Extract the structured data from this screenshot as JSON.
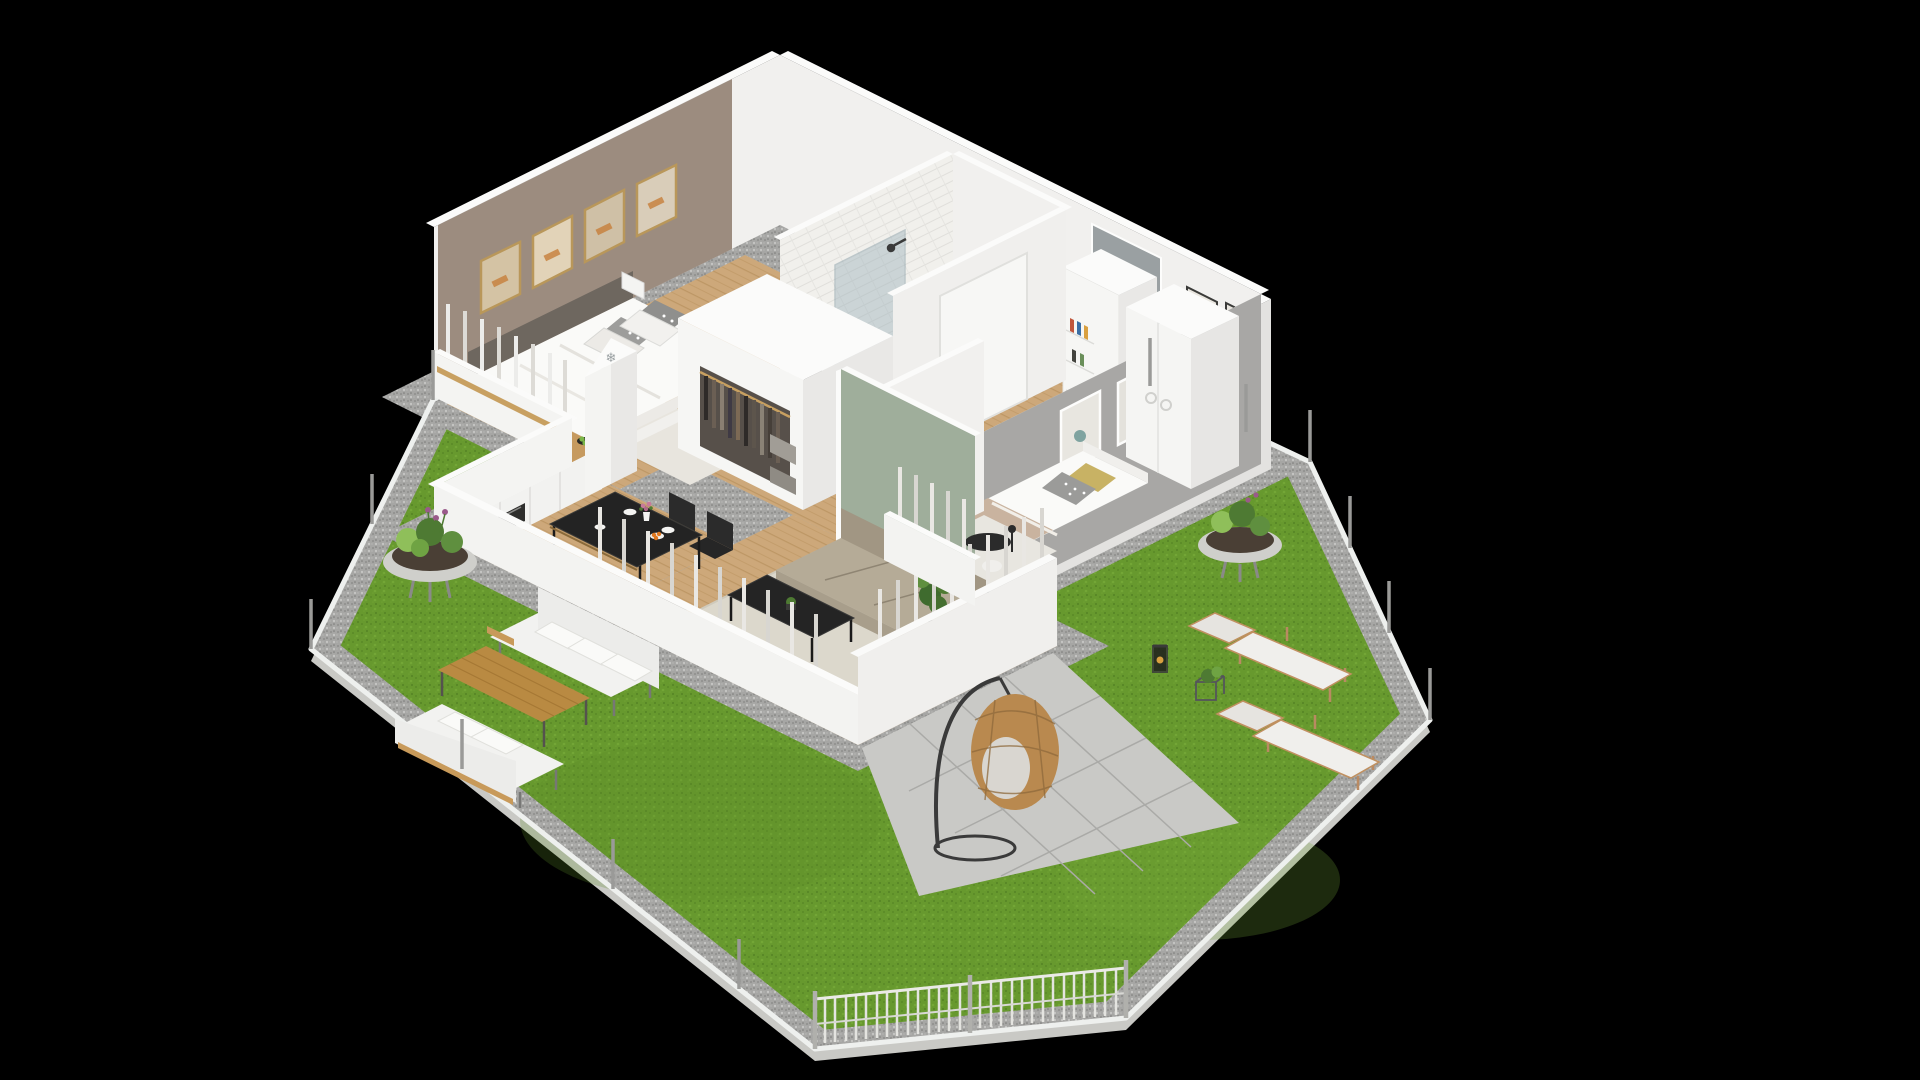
{
  "app": {
    "name": "isometric-floor-plan-render",
    "background": "#000000"
  },
  "scene": {
    "description": "3D isometric cutaway floor plan of an apartment with private garden, rendered on black background",
    "view": "isometric bird's-eye"
  },
  "icons": {
    "snowflake": "❄"
  },
  "rooms": [
    {
      "id": "bedroom-1",
      "label": "Main bedroom",
      "wall_color": "#9c8c7f",
      "furniture": [
        "double-bed",
        "headboard",
        "patterned-pillows",
        "gold-framed-pictures",
        "open-wardrobe-with-clothes",
        "storage-boxes",
        "foot-bench",
        "window-with-curtains"
      ]
    },
    {
      "id": "bathroom",
      "label": "Bathroom",
      "wall_color": "#f1f0ec",
      "furniture": [
        "bathtub",
        "glass-shower",
        "vanity-sink",
        "mirror",
        "washing-machine",
        "patterned-tile-floor"
      ]
    },
    {
      "id": "hallway",
      "label": "Entrance hall",
      "wall_color": "#f1f0ee",
      "furniture": [
        "front-door",
        "framed-pictures",
        "built-in-cabinet",
        "book-shelf",
        "door-mat"
      ]
    },
    {
      "id": "bedroom-2",
      "label": "Second bedroom",
      "wall_color": "#a8a7a5",
      "furniture": [
        "single-bed",
        "mustard-pillow",
        "dotted-pillow",
        "white-wardrobe",
        "framed-pictures",
        "fluffy-rug",
        "pouf",
        "reading-lamp",
        "half-wall-bookshelf"
      ]
    },
    {
      "id": "living-room",
      "label": "Living room",
      "wall_color": "#9fae9b",
      "furniture": [
        "beige-sofa",
        "black-coffee-table",
        "plant-on-table",
        "cream-rug",
        "floor-lamp",
        "tall-potted-plant",
        "tv-sideboard",
        "window-curtains"
      ]
    },
    {
      "id": "kitchen-dining",
      "label": "Kitchen and dining",
      "wall_color": "#f2f2f0",
      "furniture": [
        "kitchen-counter-wood-top",
        "black-sink",
        "faucet",
        "induction-hob",
        "oven",
        "fridge-with-snowflake",
        "fruit-bowl",
        "dining-table",
        "four-black-chairs",
        "plates",
        "flower-vase",
        "orange-fruit-plate"
      ]
    }
  ],
  "garden": {
    "lawn_color": "#67992e",
    "elements": [
      "gravel-border",
      "white-curb",
      "round-planter-bowl-left",
      "round-planter-bowl-right",
      "outdoor-sofa-upper",
      "outdoor-sofa-lower",
      "wooden-coffee-table",
      "sun-lounger-upper",
      "sun-lounger-lower",
      "stone-patio",
      "hanging-egg-chair",
      "lantern",
      "wire-plant-stand",
      "metal-fence-posts",
      "picket-fence"
    ]
  },
  "colors": {
    "background": "#000000",
    "wall_white": "#f1f0ee",
    "wall_bright": "#fbfbfa",
    "wall_outer": "#e3e2e0",
    "taupe": "#9c8c7f",
    "gray_accent": "#a8a7a5",
    "sage": "#9fae9b",
    "door_gray": "#9aa0a2",
    "wood_floor": "#cda87a",
    "wood_counter": "#c69a5f",
    "wood_outdoor": "#b98a42",
    "grass": "#67992e",
    "gravel_base": "#a6a6a4",
    "paver": "#c9c9c6",
    "curb": "#eef0ee",
    "black_furniture": "#222222",
    "sofa_beige": "#a89e8b",
    "rug": "#dcd8cc",
    "rattan": "#b9894f",
    "bed_white": "#fafaf8",
    "blanket_tan": "#c9b39f",
    "pillow_mustard": "#c8b264",
    "plant_green": "#4e7a33",
    "plant_light": "#8fbf5a",
    "frame_gold": "#b9975a",
    "metal": "#9a9a98",
    "curtain": "#e9e7e3"
  }
}
